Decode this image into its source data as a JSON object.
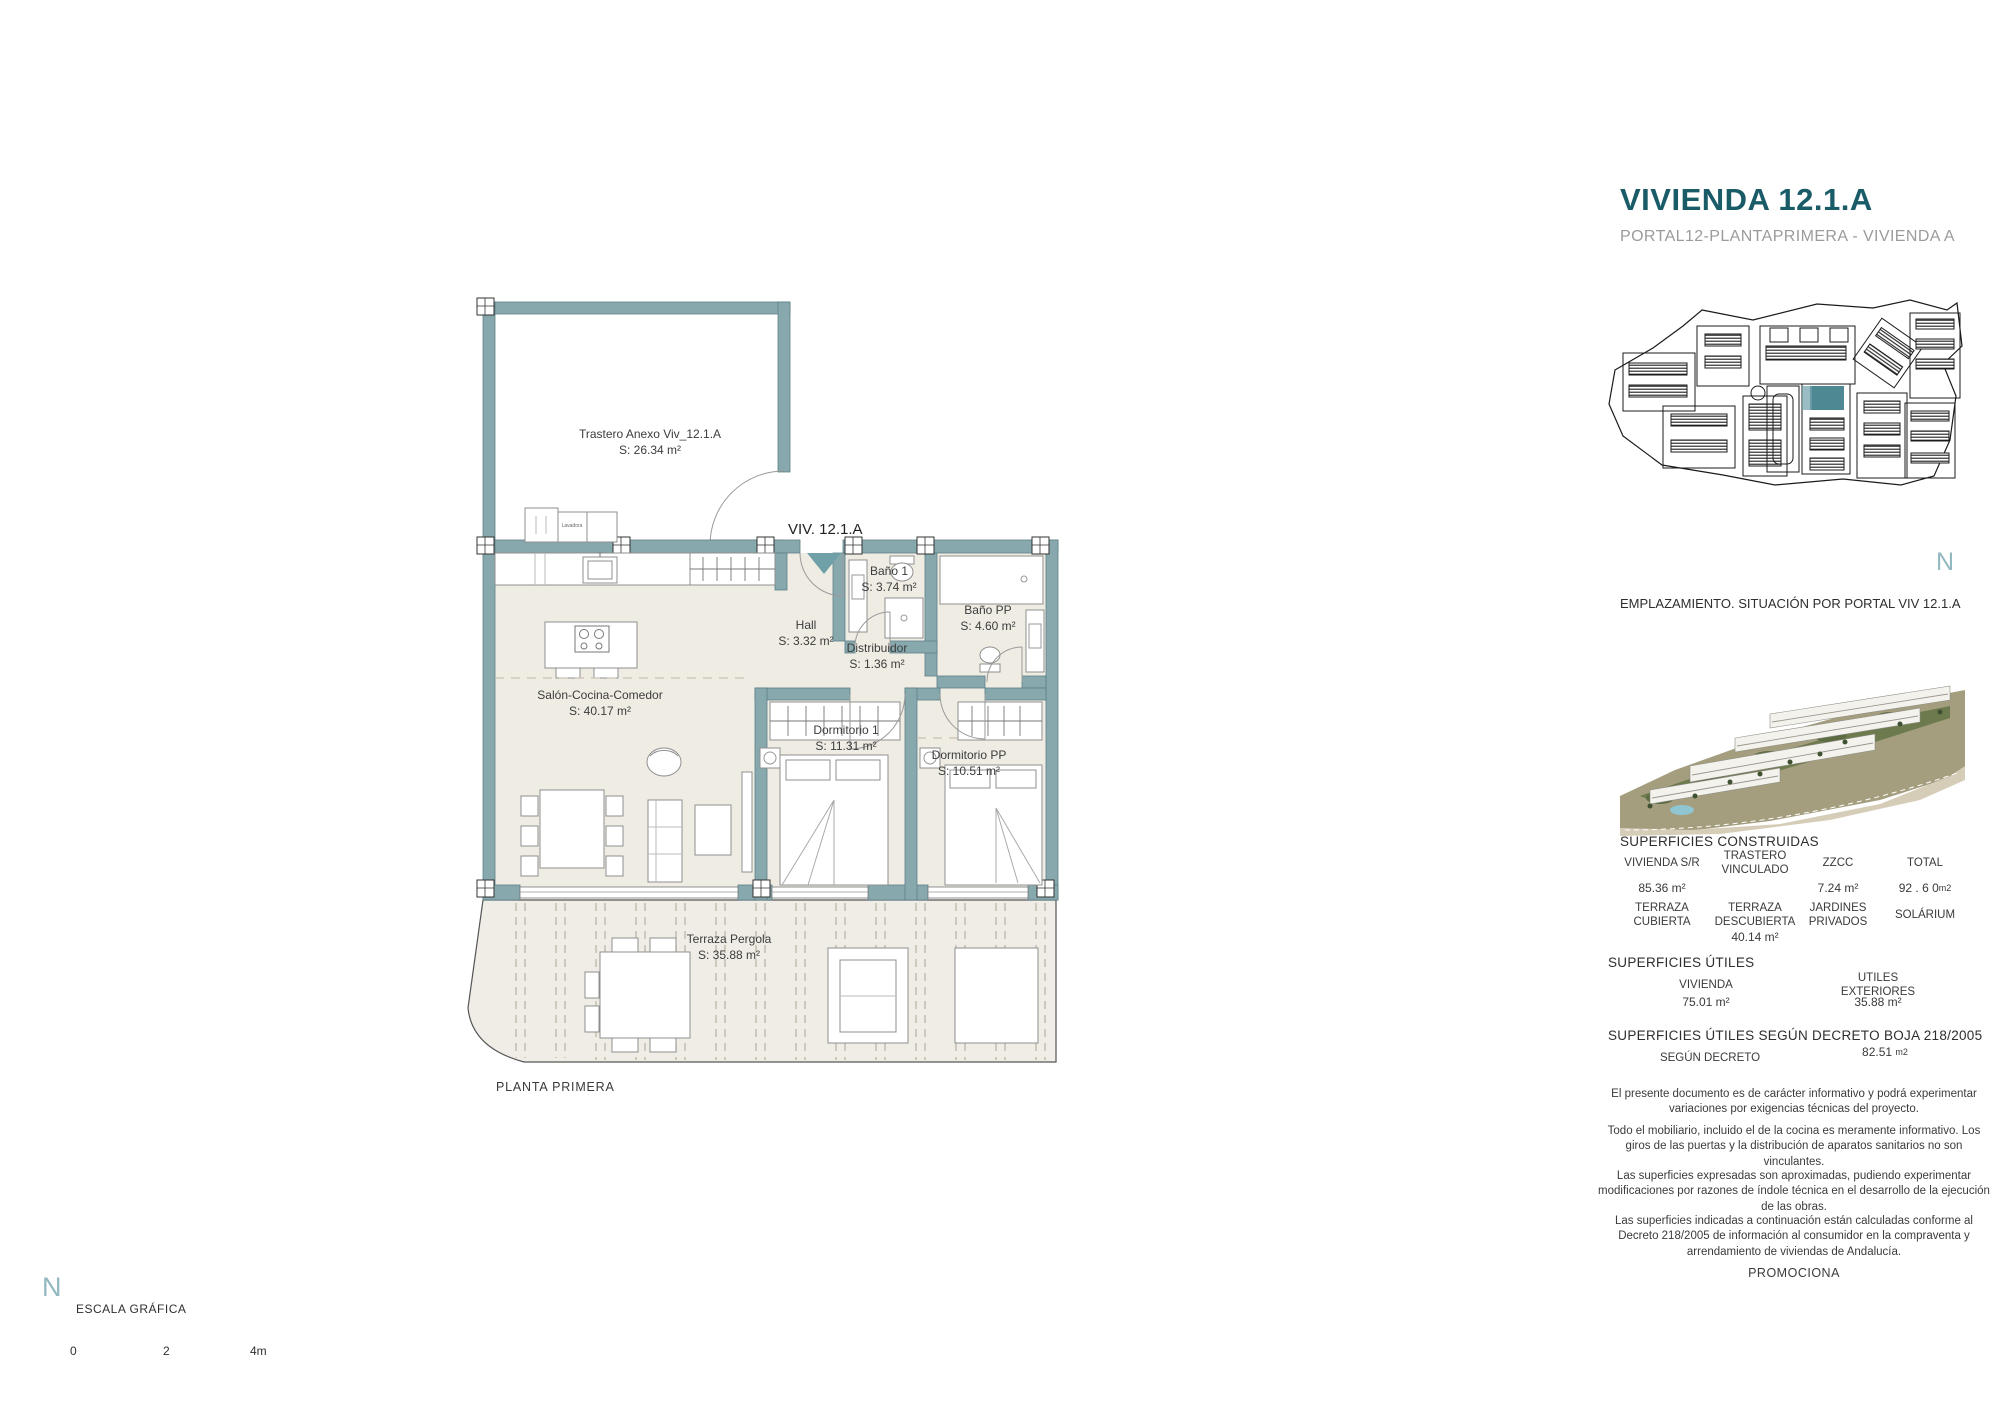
{
  "header": {
    "title": "VIVIENDA 12.1.A",
    "subtitle": "PORTAL12-PLANTAPRIMERA - VIVIENDA A"
  },
  "site": {
    "caption": "EMPLAZAMIENTO. SITUACIÓN POR PORTAL VIV 12.1.A",
    "north": "N"
  },
  "plan": {
    "entry": "VIV. 12.1.A",
    "floor": "PLANTA PRIMERA",
    "washer": "Lavadora",
    "rooms": [
      {
        "name": "Trastero Anexo Viv_12.1.A",
        "area": "S: 26.34 m²"
      },
      {
        "name": "Salón-Cocina-Comedor",
        "area": "S: 40.17 m²"
      },
      {
        "name": "Hall",
        "area": "S: 3.32 m²"
      },
      {
        "name": "Baño 1",
        "area": "S: 3.74 m²"
      },
      {
        "name": "Distribuidor",
        "area": "S: 1.36 m²"
      },
      {
        "name": "Baño PP",
        "area": "S: 4.60 m²"
      },
      {
        "name": "Dormitorio 1",
        "area": "S: 11.31 m²"
      },
      {
        "name": "Dormitorio PP",
        "area": "S: 10.51 m²"
      },
      {
        "name": "Terraza Pergola",
        "area": "S: 35.88 m²"
      }
    ]
  },
  "scalebar": {
    "north": "N",
    "title": "ESCALA GRÁFICA",
    "t0": "0",
    "t1": "2",
    "t2": "4m"
  },
  "construidas": {
    "title": "SUPERFICIES CONSTRUIDAS",
    "h1": [
      "VIVIENDA S/R",
      "TRASTERO VINCULADO",
      "ZZCC",
      "TOTAL"
    ],
    "v1": [
      "85.36 m²",
      "",
      "7.24 m²",
      "92 . 6 0"
    ],
    "total_unit": "m2",
    "h2": [
      "TERRAZA CUBIERTA",
      "TERRAZA DESCUBIERTA",
      "JARDINES PRIVADOS",
      "SOLÁRIUM"
    ],
    "v2": [
      "",
      "40.14 m²",
      "",
      ""
    ]
  },
  "utiles": {
    "title": "SUPERFICIES ÚTILES",
    "h": [
      "VIVIENDA",
      "UTILES EXTERIORES"
    ],
    "v": [
      "75.01 m²",
      "35.88 m²"
    ]
  },
  "decreto": {
    "title": "SUPERFICIES ÚTILES SEGÚN DECRETO BOJA 218/2005",
    "label": "SEGÚN DECRETO",
    "value": "82.51",
    "unit": "m2"
  },
  "legal": {
    "p1": "El presente documento es de carácter informativo y podrá experimentar variaciones por exigencias técnicas del proyecto.",
    "p2": "Todo el mobiliario, incluido el de la cocina es meramente informativo. Los giros de las puertas y la distribución de aparatos sanitarios no son vinculantes.",
    "p3": "Las superficies expresadas son aproximadas, pudiendo experimentar modificaciones por razones de índole técnica en el desarrollo de la ejecución de las obras.",
    "p4": "Las superficies indicadas a continuación están calculadas conforme al Decreto 218/2005 de información al consumidor en la compraventa y arrendamiento de viviendas de Andalucía.",
    "promociona": "PROMOCIONA"
  },
  "colors": {
    "wall": "#87a9ae",
    "accent": "#1a5b68",
    "highlight": "#2e7380",
    "floor": "#efece3",
    "terrace": "#f0ede6"
  }
}
